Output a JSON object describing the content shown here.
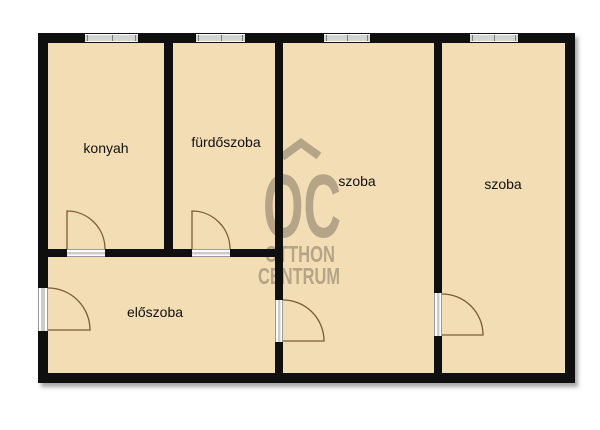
{
  "floorplan": {
    "rooms": [
      {
        "id": "kitchen",
        "label": "konyah"
      },
      {
        "id": "bathroom",
        "label": "fürdőszoba"
      },
      {
        "id": "room-1",
        "label": "szoba"
      },
      {
        "id": "room-2",
        "label": "szoba"
      },
      {
        "id": "hallway",
        "label": "előszoba"
      }
    ],
    "watermark": {
      "logo_text": "OC",
      "name_line1": "OTTHON",
      "name_line2": "CENTRUM"
    },
    "counts": {
      "windows": 4,
      "doors": 5
    },
    "colors": {
      "background": "#ffffff",
      "room_fill": "#f3ddb4",
      "wall": "#0f0f0f",
      "watermark": "#b0a084",
      "door_line": "#7a5b3a",
      "window_fill": "#d4d4d4"
    }
  }
}
